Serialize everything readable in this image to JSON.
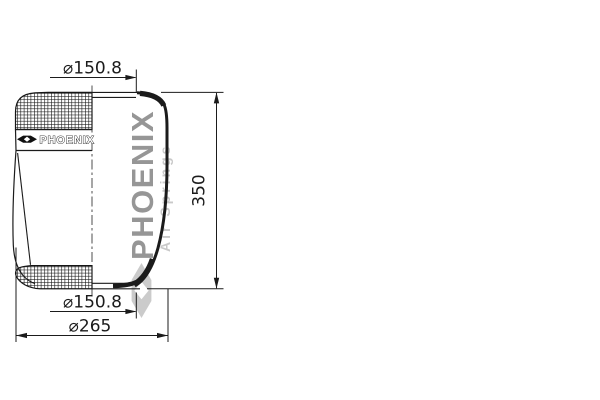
{
  "drawing": {
    "dimensions": {
      "top_diameter": "⌀150.8",
      "bottom_diameter": "⌀150.8",
      "max_diameter": "⌀265",
      "height": "350"
    },
    "label": {
      "brand": "PHOENIX"
    },
    "watermark": {
      "brand": "PHOENIX",
      "subtitle": "Air Springs"
    },
    "colors": {
      "line": "#1b1b1b",
      "watermark_primary": "#969696",
      "watermark_secondary": "#c9c9c9",
      "watermark_logo": "#c3c3c3",
      "background": "#ffffff"
    }
  }
}
